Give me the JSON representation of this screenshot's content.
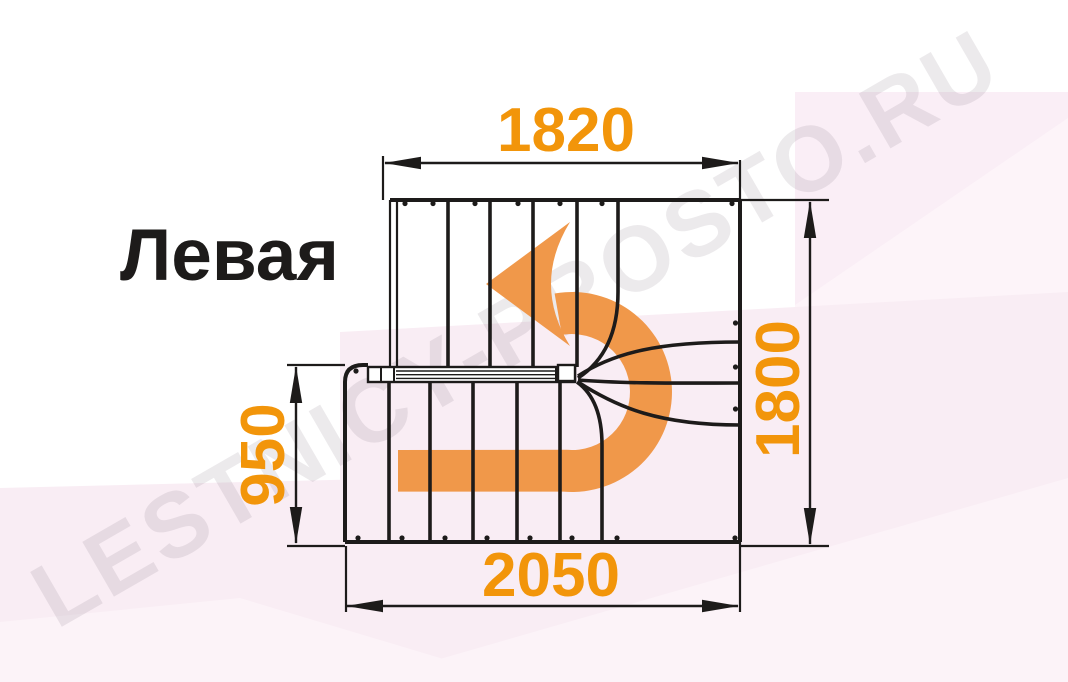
{
  "diagram": {
    "title": "Левая",
    "watermark": "LESTNICY-PROSTO.RU",
    "type_note": "staircase U-turn plan view with winder steps, direction arrow turning left",
    "dimensions": {
      "top": "1820",
      "right": "1800",
      "left": "950",
      "bottom": "2050"
    }
  },
  "colors": {
    "dimension_text_orange": "#F2950A",
    "arrow_orange": "#F0984A",
    "linework_black": "#1D1B1A",
    "background_pink": "#F9EDF4",
    "watermark_gray": "#E8E4E8"
  }
}
